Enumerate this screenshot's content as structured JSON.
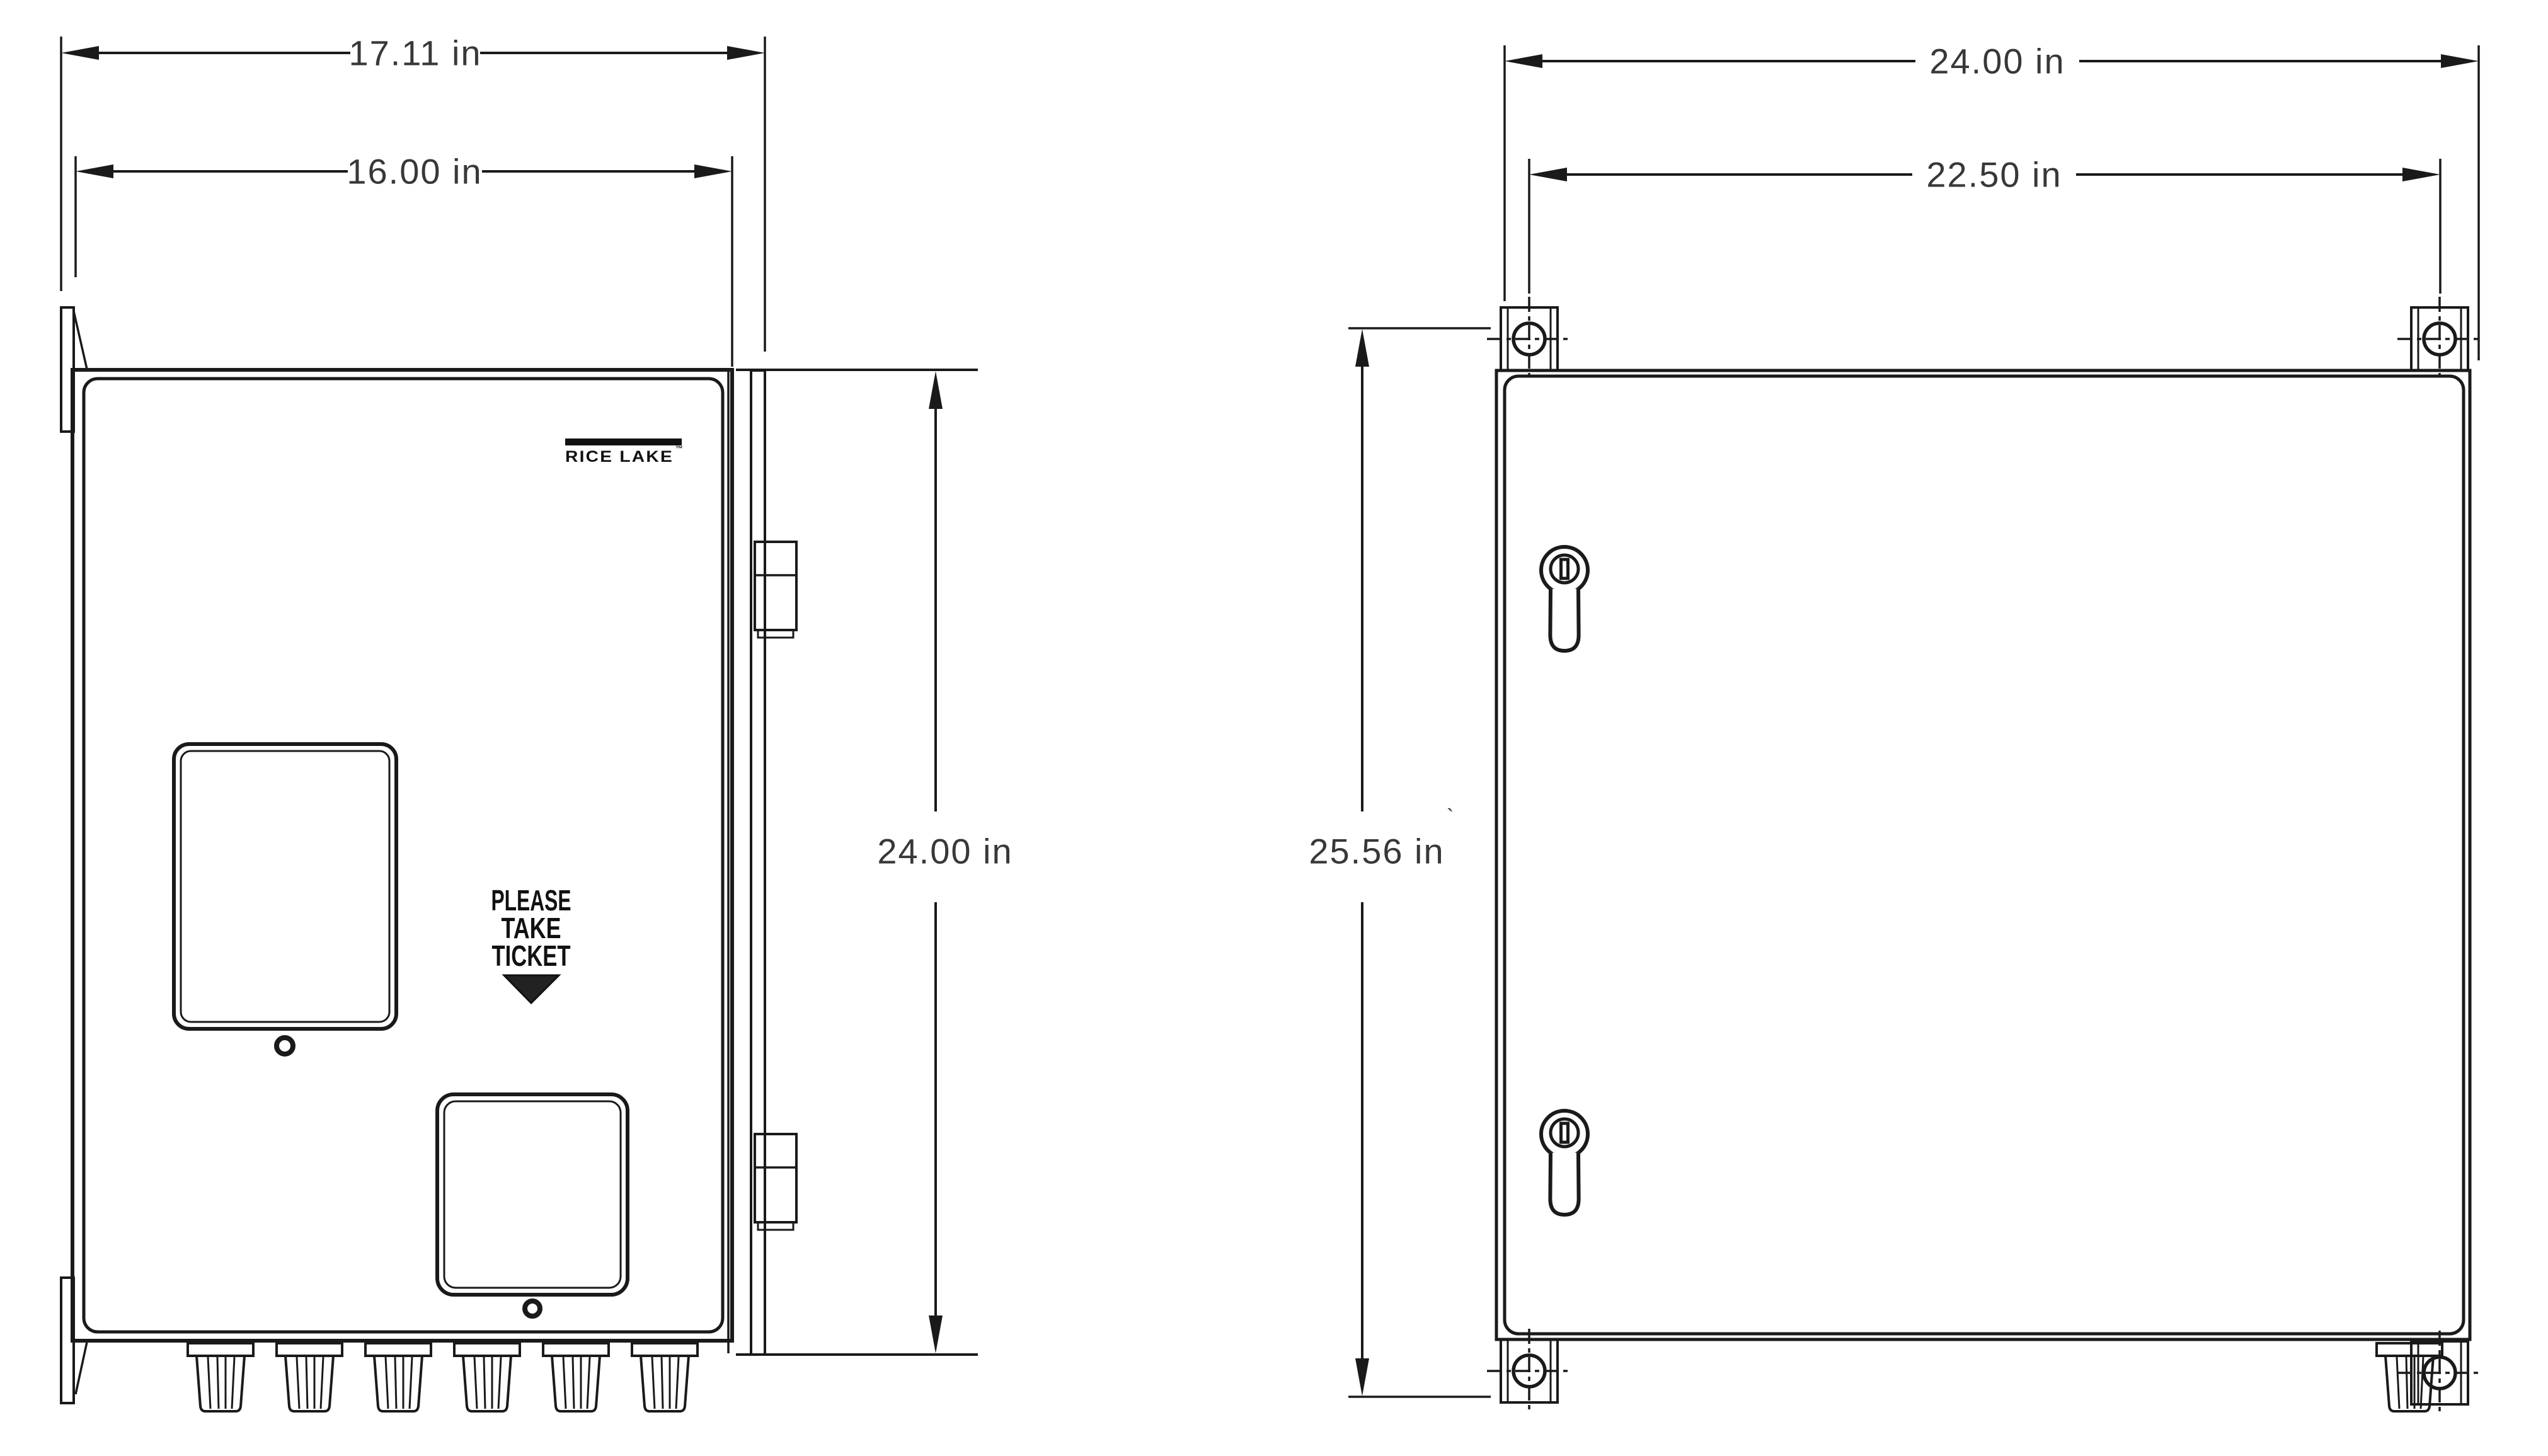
{
  "drawing": {
    "front_view": {
      "logo_text": "RICE LAKE",
      "logo_tm": "™",
      "ticket_label_lines": [
        "PLEASE",
        "TAKE",
        "TICKET"
      ],
      "dimensions": {
        "overall_width": "17.11 in",
        "door_width": "16.00 in",
        "height": "24.00 in"
      }
    },
    "side_view": {
      "dimensions": {
        "overall_width": "24.00 in",
        "mount_hole_spacing": "22.50 in",
        "overall_height": "25.56 in"
      },
      "stray_mark": "`"
    },
    "colors": {
      "line": "#1a1a1a",
      "dim_text": "#383838",
      "background": "#ffffff",
      "arrow_fill": "#1a1a1a",
      "triangle_fill": "#222222"
    }
  }
}
